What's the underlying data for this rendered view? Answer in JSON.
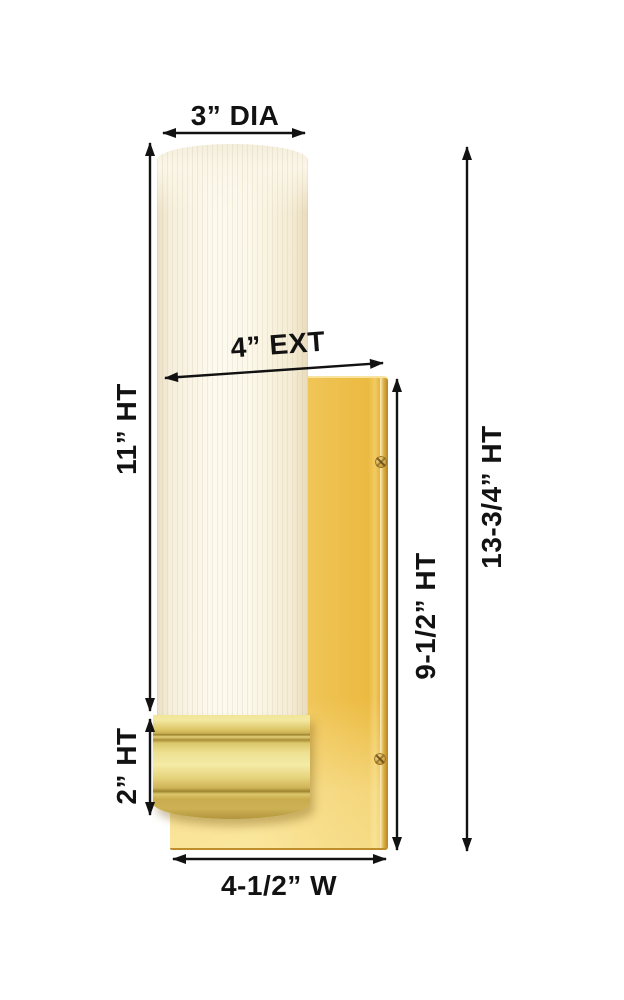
{
  "diagram": {
    "title": "Wall sconce dimension diagram",
    "product": {
      "type": "single-light wall sconce",
      "parts": [
        "ribbed glass cylinder shade",
        "gold base collar",
        "gold rectangular backplate",
        "mounting screws"
      ]
    },
    "dimensions": {
      "diameter": {
        "label": "3” DIA",
        "meaning": "shade diameter"
      },
      "extension": {
        "label": "4” EXT",
        "meaning": "extension from wall"
      },
      "glass_height": {
        "label": "11” HT",
        "meaning": "glass shade height"
      },
      "backplate_height": {
        "label": "9-1/2” HT",
        "meaning": "backplate height"
      },
      "total_height": {
        "label": "13-3/4” HT",
        "meaning": "overall fixture height"
      },
      "base_height": {
        "label": "2” HT",
        "meaning": "base collar height"
      },
      "width": {
        "label": "4-1/2” W",
        "meaning": "backplate width"
      }
    },
    "colors": {
      "background": "#FFFFFF",
      "line": "#121212",
      "gold": "#EFC24F",
      "gold_dark": "#C08F2B",
      "gold_light": "#F8E49E",
      "glass": "#FBF6E8"
    }
  }
}
